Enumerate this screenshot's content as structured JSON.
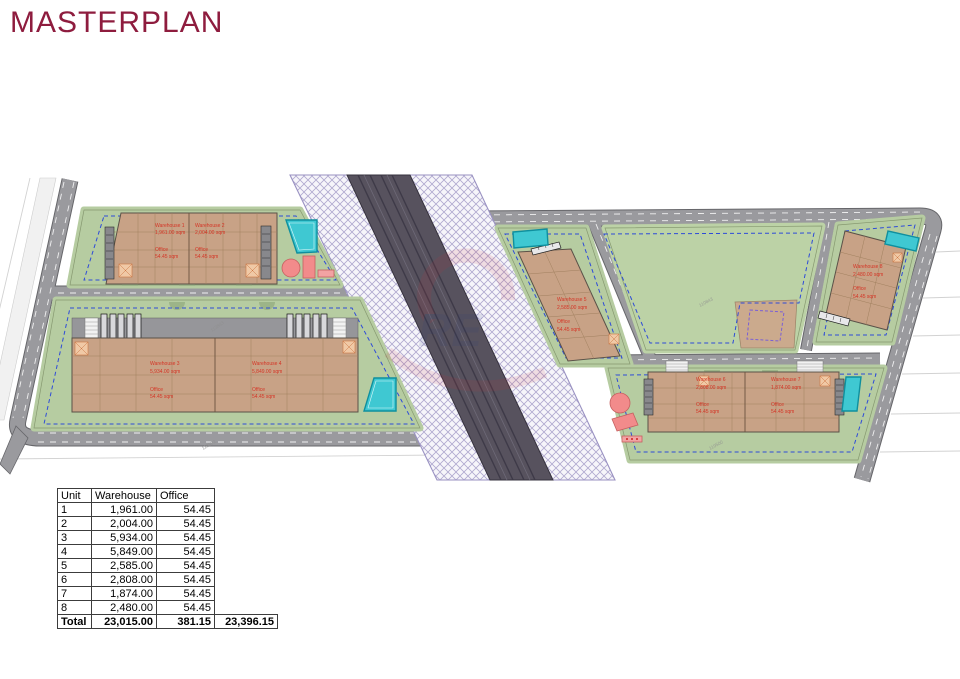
{
  "title": "MASTERPLAN",
  "watermark": {
    "text": "RE"
  },
  "colors": {
    "title": "#8e1c3e",
    "label_red": "#d43425",
    "building_tan": "#c8a286",
    "plot_green": "#b6cca1",
    "pond_teal": "#3fc8d2",
    "road_grey": "#9a9a9e",
    "corridor_dark": "#57525e",
    "boundary_blue": "#2e4bd8",
    "boundary_purple": "#7a5fd6"
  },
  "plan": {
    "units": [
      {
        "name": "Warehouse 1",
        "area": "1,961.00 sqm",
        "office_label": "Office",
        "office_area": "54.45 sqm"
      },
      {
        "name": "Warehouse 2",
        "area": "2,004.00 sqm",
        "office_label": "Office",
        "office_area": "54.45 sqm"
      },
      {
        "name": "Warehouse 3",
        "area": "5,934.00 sqm",
        "office_label": "Office",
        "office_area": "54.45 sqm"
      },
      {
        "name": "Warehouse 4",
        "area": "5,849.00 sqm",
        "office_label": "Office",
        "office_area": "54.45 sqm"
      },
      {
        "name": "Warehouse 5",
        "area": "2,585.00 sqm",
        "office_label": "Office",
        "office_area": "54.45 sqm"
      },
      {
        "name": "Warehouse 6",
        "area": "2,808.00 sqm",
        "office_label": "Office",
        "office_area": "54.45 sqm"
      },
      {
        "name": "Warehouse 7",
        "area": "1,874.00 sqm",
        "office_label": "Office",
        "office_area": "54.45 sqm"
      },
      {
        "name": "Warehouse 8",
        "area": "2,480.00 sqm",
        "office_label": "Office",
        "office_area": "54.45 sqm"
      }
    ],
    "parcels": [
      "113843",
      "118982",
      "110843",
      "119500"
    ]
  },
  "table": {
    "headers": [
      "Unit",
      "Warehouse",
      "Office"
    ],
    "rows": [
      {
        "unit": "1",
        "warehouse": "1,961.00",
        "office": "54.45"
      },
      {
        "unit": "2",
        "warehouse": "2,004.00",
        "office": "54.45"
      },
      {
        "unit": "3",
        "warehouse": "5,934.00",
        "office": "54.45"
      },
      {
        "unit": "4",
        "warehouse": "5,849.00",
        "office": "54.45"
      },
      {
        "unit": "5",
        "warehouse": "2,585.00",
        "office": "54.45"
      },
      {
        "unit": "6",
        "warehouse": "2,808.00",
        "office": "54.45"
      },
      {
        "unit": "7",
        "warehouse": "1,874.00",
        "office": "54.45"
      },
      {
        "unit": "8",
        "warehouse": "2,480.00",
        "office": "54.45"
      }
    ],
    "total": {
      "label": "Total",
      "warehouse": "23,015.00",
      "office": "381.15",
      "grand": "23,396.15"
    }
  }
}
